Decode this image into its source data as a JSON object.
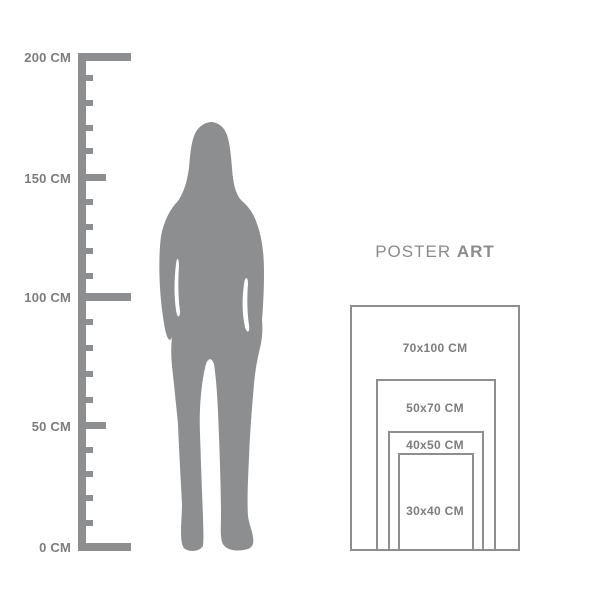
{
  "title": {
    "regular": "POSTER",
    "bold": "ART"
  },
  "ruler": {
    "unit": "CM",
    "labels": [
      {
        "value": "200 CM"
      },
      {
        "value": "150 CM"
      },
      {
        "value": "100 CM"
      },
      {
        "value": "50 CM"
      },
      {
        "value": "0 CM"
      }
    ]
  },
  "figure": {
    "icon": "woman-silhouette"
  },
  "poster_sizes": [
    {
      "label": "70x100 CM"
    },
    {
      "label": "50x70 CM"
    },
    {
      "label": "40x50 CM"
    },
    {
      "label": "30x40 CM"
    }
  ],
  "colors": {
    "gray": "#8d8e90",
    "label_text": "#7c7d7f",
    "title_text": "#8a8b8d",
    "background": "#ffffff"
  }
}
